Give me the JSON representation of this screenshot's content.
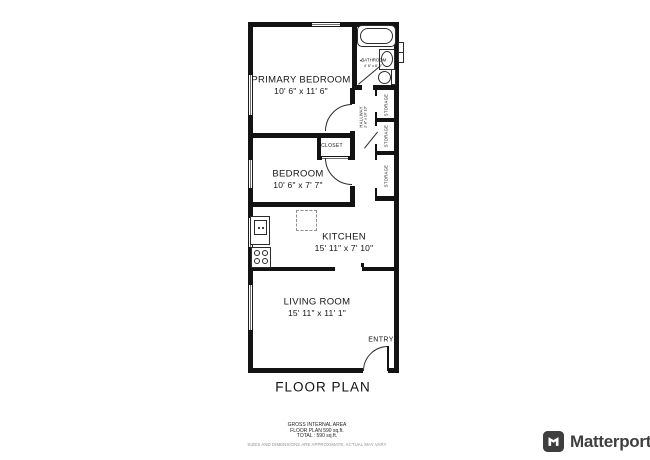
{
  "plan": {
    "title": "FLOOR PLAN",
    "rooms": {
      "primary_bedroom": {
        "name": "PRIMARY BEDROOM",
        "dims": "10' 6\" x 11' 6\""
      },
      "bedroom": {
        "name": "BEDROOM",
        "dims": "10' 6\" x 7' 7\""
      },
      "kitchen": {
        "name": "KITCHEN",
        "dims": "15' 11\" x 7' 10\""
      },
      "living_room": {
        "name": "LIVING ROOM",
        "dims": "15' 11\" x 11' 1\""
      },
      "bathroom": {
        "name": "BATHROOM",
        "dims": "4' 6\" x 6' 8\"",
        "marker": "◂"
      },
      "hallway": {
        "name": "HALLWAY",
        "dims": "2' 8\" x 10' 10\""
      },
      "closet": {
        "name": "CLOSET"
      },
      "entry": {
        "name": "ENTRY"
      },
      "storage": {
        "name": "STORAGE"
      }
    }
  },
  "footer": {
    "area_title": "GROSS INTERNAL AREA",
    "area_line1": "FLOOR PLAN 590 sq.ft.",
    "area_line2": "TOTAL :  590 sq.ft.",
    "disclaimer": "SIZES AND DIMENSIONS ARE APPROXIMATE, ACTUAL MAY VARY"
  },
  "brand": {
    "name": "Matterport"
  },
  "colors": {
    "wall": "#131313",
    "fixture_line": "#2b2b2b",
    "brand": "#3f3f3f",
    "disclaimer_text": "#8f8f8f"
  }
}
